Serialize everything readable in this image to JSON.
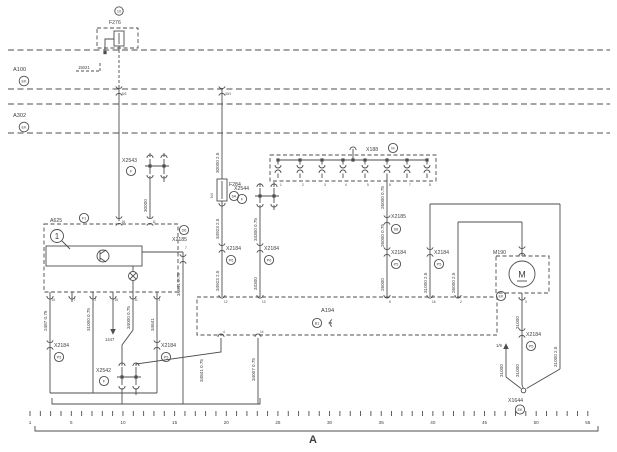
{
  "c": {
    "f276": {
      "id": "F276",
      "badge": "10"
    },
    "a100": {
      "id": "A100",
      "badge": "EK"
    },
    "a302": {
      "id": "A302",
      "badge": "EK"
    },
    "ref15021": "15021",
    "tap1": "5/3",
    "tap2": "30/1",
    "x2543": {
      "id": "X2543",
      "badge": "F"
    },
    "f284": {
      "id": "F284",
      "badge": "6A",
      "slot": "N4"
    },
    "x2544": {
      "id": "X2544",
      "badge": "F"
    },
    "x188": {
      "id": "X188",
      "badge": "M",
      "pins": [
        "1",
        "2",
        "3",
        "4",
        "5",
        "6",
        "7",
        "8"
      ]
    },
    "a625": {
      "id": "A625",
      "badge": "F1",
      "callout": "1",
      "pins_top": [
        "16",
        "11"
      ],
      "pins_bottom": [
        "10",
        "7",
        "2",
        "15",
        "11",
        "1"
      ]
    },
    "x2185a": {
      "id": "X2185",
      "badge": "D6",
      "pin": "7"
    },
    "x2185b": {
      "id": "X2185",
      "badge": "D8"
    },
    "x2184a": {
      "id": "X2184",
      "badge": "P5"
    },
    "x2184b": {
      "id": "X2184",
      "badge": "P5"
    },
    "x2184c": {
      "id": "X2184",
      "badge": "P6"
    },
    "x2184d": {
      "id": "X2184",
      "badge": "P6"
    },
    "x2184e": {
      "id": "X2184",
      "badge": "P5"
    },
    "x2184f": {
      "id": "X2184",
      "badge": "P5"
    },
    "x2184g": {
      "id": "X2184",
      "badge": "P5"
    },
    "x2542": {
      "id": "X2542",
      "badge": "F"
    },
    "a194": {
      "id": "A194",
      "badge": "B1",
      "pins_top": [
        "12",
        "13",
        "6",
        "16",
        "2"
      ],
      "pins_bottom": [
        "4",
        "14"
      ]
    },
    "m190": {
      "id": "M190",
      "motor": "M",
      "badge": "EK",
      "pin": "3"
    },
    "x1644": {
      "id": "X1644",
      "badge": "EK"
    },
    "ref1447": "1447",
    "ref19": "1/9"
  },
  "w": {
    "w1": "30000 2.5",
    "w2": "30000",
    "w3a": "34923 2.5",
    "w3b": "34923 2.5",
    "w4a": "34300 0.75",
    "w4b": "34300",
    "w5": "2487 0.75",
    "w6": "31000 0.75",
    "w7": "34000 0.75",
    "w8": "34641",
    "w9": "34641 0.75",
    "w10": "34841 0.75",
    "w11": "34007 0.75",
    "w12a": "26000 0.75",
    "w12b": "26000 0.75",
    "w12c": "26000",
    "w13": "31000 2.5",
    "w14": "26000 2.5",
    "w15a": "31000",
    "w15b": "31000",
    "w15c": "31000",
    "w16": "31000 2.5"
  },
  "ruler": {
    "numbers": [
      1,
      5,
      10,
      15,
      20,
      25,
      30,
      35,
      40,
      45,
      50,
      55
    ],
    "label": "A"
  }
}
